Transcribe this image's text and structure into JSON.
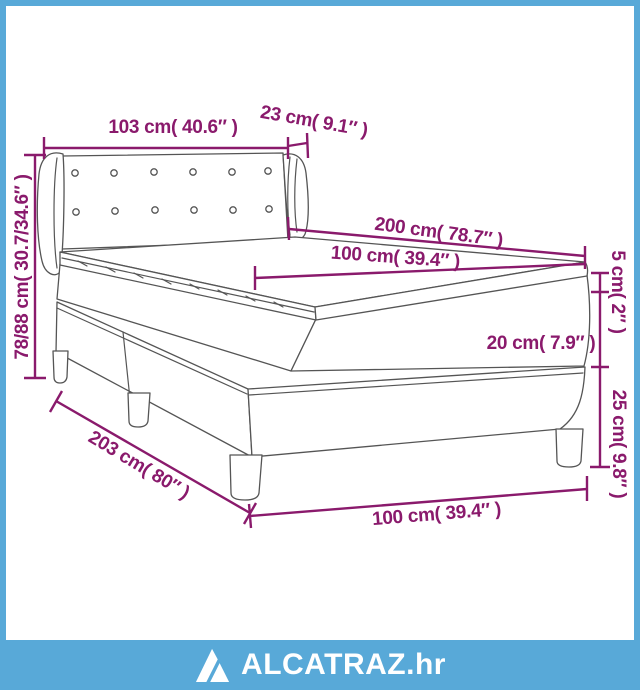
{
  "page": {
    "background": "#ffffff",
    "frame_color": "#58a9d8",
    "line_art_color": "#555555",
    "dimension_color": "#8a1a6c"
  },
  "diagram": {
    "type": "bed-dimension-diagram",
    "dimensions": {
      "headboard_width": {
        "label": "103 cm( 40.6″ )"
      },
      "headboard_depth": {
        "label": "23 cm( 9.1″ )"
      },
      "headboard_height": {
        "label": "78/88 cm( 30.7/34.6″ )"
      },
      "bed_length": {
        "label": "200 cm( 78.7″ )"
      },
      "mattress_width": {
        "label": "100 cm( 39.4″ )"
      },
      "topper_height": {
        "label": "5 cm( 2″ )"
      },
      "mattress_height": {
        "label": "20 cm( 7.9″ )"
      },
      "base_height": {
        "label": "25 cm( 9.8″ )"
      },
      "base_length": {
        "label": "203 cm( 80″ )"
      },
      "base_width": {
        "label": "100 cm( 39.4″ )"
      }
    }
  },
  "footer": {
    "brand": "ALCATRAZ.hr"
  }
}
